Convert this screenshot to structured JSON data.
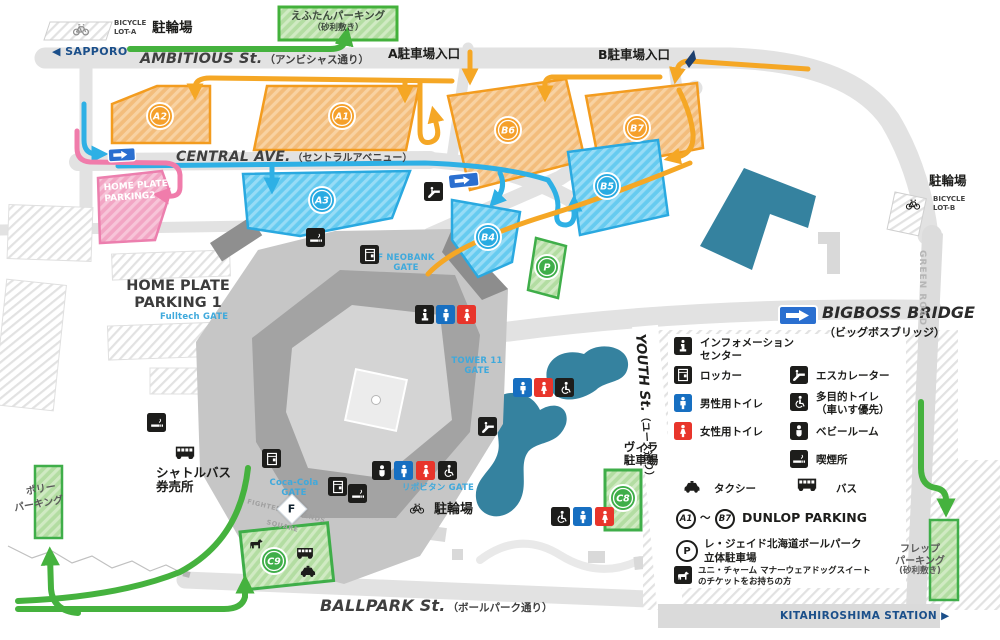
{
  "colors": {
    "lot_orange": "#f5a02b",
    "lot_blue": "#29abe2",
    "lot_green": "#3fae49",
    "lot_pink": "#ee7bab",
    "route_green": "#45b23e",
    "route_cyan": "#2eb0e5",
    "route_orange": "#f5a725",
    "route_pink": "#f07cab",
    "navy": "#1b4f8a",
    "gate_blue": "#3fa9dc",
    "sign_blue": "#2a6fd0",
    "pond_teal": "#35829f"
  },
  "streets": {
    "ambitious_en": "AMBITIOUS St.",
    "ambitious_ja": "（アンビシャス通り）",
    "central_en": "CENTRAL AVE.",
    "central_ja": "（セントラルアベニュー）",
    "ballpark_en": "BALLPARK St.",
    "ballpark_ja": "（ボールパーク通り）",
    "youth_en": "YOUTH St.",
    "youth_ja": "（ユース通り）",
    "green_road": "GREEN ROAD",
    "sapporo": "◀ SAPPORO",
    "kitahiroshima": "KITAHIROSHIMA STATION ▶",
    "bigboss_en": "BIGBOSS BRIDGE",
    "bigboss_ja": "（ビッグボスブリッジ）",
    "entrance_a": "A駐車場入口",
    "entrance_b": "B駐車場入口"
  },
  "bicycle": {
    "lot_a_1": "BICYCLE",
    "lot_a_2": "LOT-A",
    "lot_a_label": "駐輪場",
    "lot_b_label": "駐輪場",
    "lot_b_1": "BICYCLE",
    "lot_b_2": "LOT-B",
    "south_label": "駐輪場"
  },
  "parking": {
    "eftan_1": "えふたんパーキング",
    "eftan_2": "（砂利敷き）",
    "homeplate2_1": "HOME PLATE",
    "homeplate2_2": "PARKING2",
    "homeplate1_1": "HOME PLATE",
    "homeplate1_2": "PARKING 1",
    "polly_1": "ポリー",
    "polly_2": "パーキング",
    "frep_1": "フレップ",
    "frep_2": "パーキング",
    "frep_3": "(砂利敷き)",
    "villa_1": "ヴィラ",
    "villa_2": "駐車場",
    "a1": "A1",
    "a2": "A2",
    "a3": "A3",
    "b4": "B4",
    "b5": "B5",
    "b6": "B6",
    "b7": "B7",
    "p": "P",
    "c8": "C8",
    "c9": "C9"
  },
  "gates": {
    "fulltech": "Fulltech GATE",
    "fneobank_1": "F NEOBANK",
    "fneobank_2": "GATE",
    "tower11_1": "TOWER 11",
    "tower11_2": "GATE",
    "cocacola_1": "Coca-Cola",
    "cocacola_2": "GATE",
    "lipovitan": "リポビタン GATE"
  },
  "places": {
    "shuttle_1": "シャトルバス",
    "shuttle_2": "券売所",
    "fighters_1": "FIGHTERS LEGENDS",
    "fighters_2": "SQUARE",
    "flogo": "F"
  },
  "legend": {
    "info_1": "インフォメーション",
    "info_2": "センター",
    "locker": "ロッカー",
    "male": "男性用トイレ",
    "female": "女性用トイレ",
    "escalator": "エスカレーター",
    "multi_1": "多目的トイレ",
    "multi_2": "（車いす優先）",
    "baby": "ベビールーム",
    "smoking": "喫煙所",
    "taxi": "タクシー",
    "bus": "バス",
    "dunlop_a1": "A1",
    "dunlop_tilde": "～",
    "dunlop_b7": "B7",
    "dunlop_label": "DUNLOP PARKING",
    "p_symbol": "P",
    "p_1": "レ・ジェイド北海道ボールパーク",
    "p_2": "立体駐車場",
    "dog_1": "ユニ・チャーム マナーウェアドッグスイート",
    "dog_2": "のチケットをお持ちの方"
  }
}
